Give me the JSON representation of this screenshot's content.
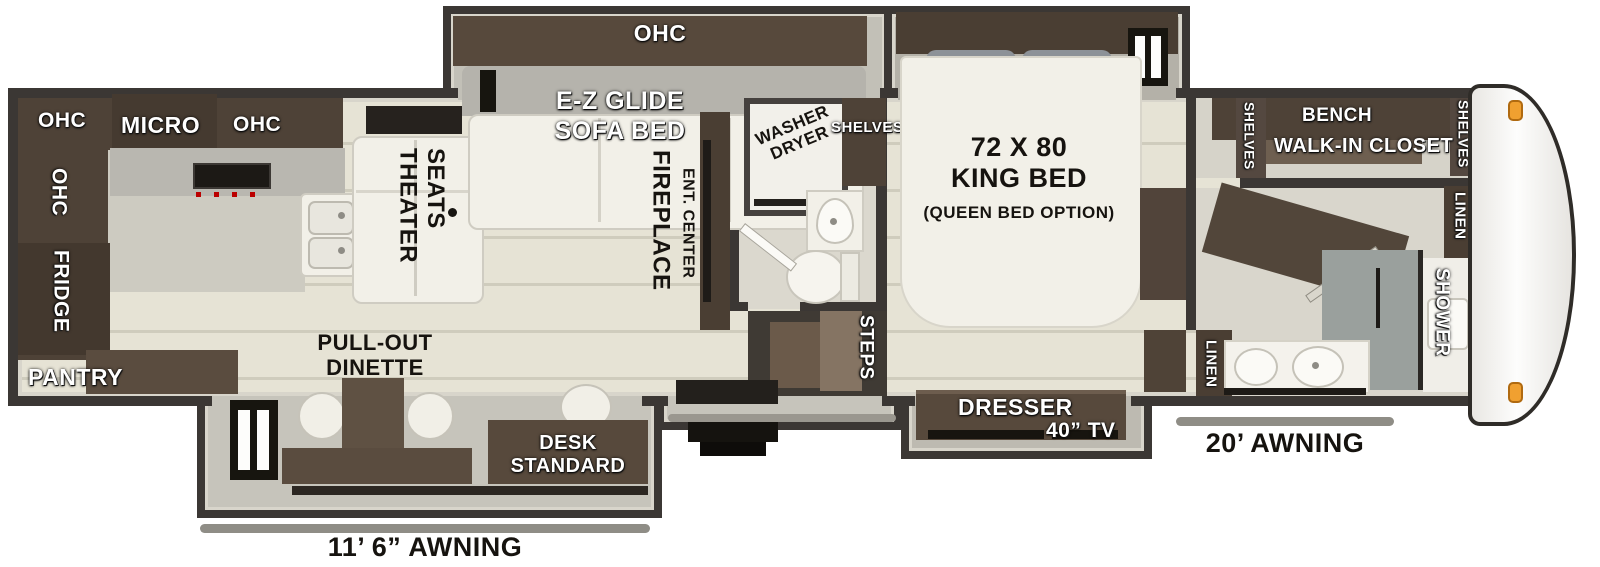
{
  "floorplan": {
    "colors": {
      "wall": "#3b3734",
      "cabinet_wood": "#4e4237",
      "floor": "#e4e1d3",
      "slide_floor": "#c2c0b7",
      "marker_light": "#f0a030",
      "awning_bar": "#8f8d86"
    },
    "kitchen": {
      "ohc_left": "OHC",
      "micro": "MICRO",
      "ohc_right": "OHC",
      "ohc_side": "OHC",
      "fridge": "FRIDGE",
      "pantry": "PANTRY"
    },
    "living": {
      "theater_line1": "THEATER",
      "theater_line2": "SEATS",
      "sofa_ohc": "OHC",
      "sofa_line1": "E-Z GLIDE",
      "sofa_line2": "SOFA BED",
      "fireplace": "FIREPLACE",
      "ent_center": "ENT. CENTER",
      "dinette_line1": "PULL-OUT",
      "dinette_line2": "DINETTE",
      "desk_line1": "DESK",
      "desk_line2": "STANDARD"
    },
    "mid_bath": {
      "washer_line1": "WASHER",
      "washer_line2": "DRYER",
      "shelves": "SHELVES",
      "steps": "STEPS"
    },
    "bedroom": {
      "bed_line1": "72 X 80",
      "bed_line2": "KING BED",
      "bed_line3": "(QUEEN BED OPTION)",
      "dresser": "DRESSER",
      "tv": "40” TV",
      "linen": "LINEN"
    },
    "closet": {
      "shelves_left": "SHELVES",
      "bench": "BENCH",
      "title": "WALK-IN CLOSET",
      "shelves_right": "SHELVES"
    },
    "front_bath": {
      "linen": "LINEN",
      "shower": "SHOWER"
    },
    "awnings": {
      "rear": "11’ 6” AWNING",
      "front": "20’ AWNING"
    }
  }
}
